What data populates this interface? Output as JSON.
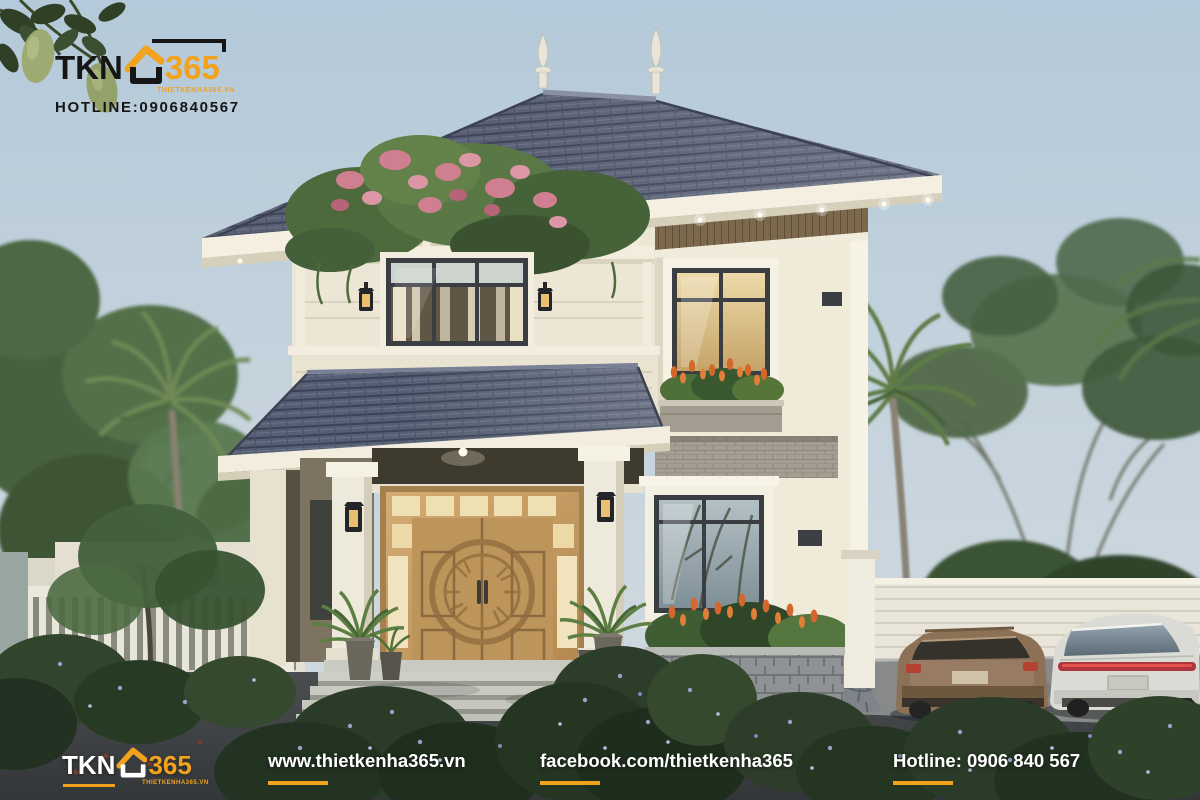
{
  "watermark": {
    "brand_prefix": "TKN",
    "brand_suffix": "365",
    "brand_tagline": "THIETKENHA365.VN",
    "hotline": "HOTLINE:0906840567"
  },
  "footer": {
    "brand_prefix": "TKN",
    "brand_suffix": "365",
    "brand_tagline": "THIETKENHA365.VN",
    "website": "www.thietkenha365.vn",
    "facebook": "facebook.com/thietkenha365",
    "hotline": "Hotline: 0906 840 567"
  },
  "colors": {
    "brand_orange": "#F2A21D",
    "brand_black": "#161616",
    "footer_text": "#FFFFFF",
    "sky": "#B9CDDA",
    "roof_tile": "#5A6174",
    "wall_cream": "#EFE9D8",
    "wood_door": "#C39A63",
    "accent_wood_band": "#7C684C",
    "foliage": "#4C663C",
    "bougainvillea_pink": "#D0808F",
    "tulip_orange": "#D76B2E",
    "asphalt": "#404345"
  }
}
